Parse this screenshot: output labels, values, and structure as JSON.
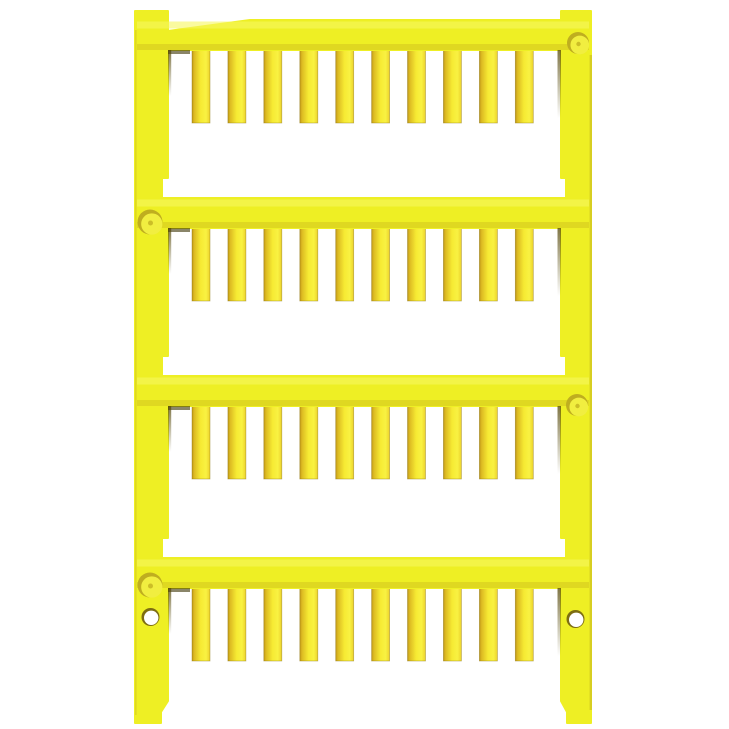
{
  "image": {
    "description": "Yellow plastic wire marker card: ladder frame with four rails of small blank marker tags",
    "background": "#ffffff",
    "colors": {
      "frame": "#eeef24",
      "frame_highlight": "#f7f65f",
      "frame_shade": "#ccbc1e",
      "frame_edge_line": "#b3991c",
      "tag_edge_dark": "#bf9718",
      "tag_gold": "#dcba22",
      "tag_mid": "#f6ea33",
      "tag_light": "#f9f242",
      "tag_right_edge": "#ecd22c",
      "tag_outline": "#8a7210",
      "edge_shadow": "#3c3305",
      "wall_shadow": "#554808",
      "dimple_base": "#bfae1f",
      "dimple_face": "#f1ee40",
      "hole_ring": "#7d6d12",
      "hole_fill": "#ffffff"
    },
    "structure": {
      "rows": 4,
      "tags_per_row": 10,
      "rail_tops": [
        20,
        198,
        376,
        558
      ],
      "rail_height": 30,
      "tag": {
        "width": 18,
        "height": 73,
        "first_x": 192,
        "pitch": 35.92
      },
      "dimples": [
        {
          "cx": 578,
          "cy": 43,
          "r": 11
        },
        {
          "cx": 150,
          "cy": 222,
          "r": 12.5
        },
        {
          "cx": 577,
          "cy": 405,
          "r": 11
        },
        {
          "cx": 150,
          "cy": 585,
          "r": 12.5
        }
      ],
      "holes": [
        {
          "cx": 150.5,
          "cy": 617,
          "r": 9
        },
        {
          "cx": 575.5,
          "cy": 619,
          "r": 9
        }
      ]
    }
  }
}
